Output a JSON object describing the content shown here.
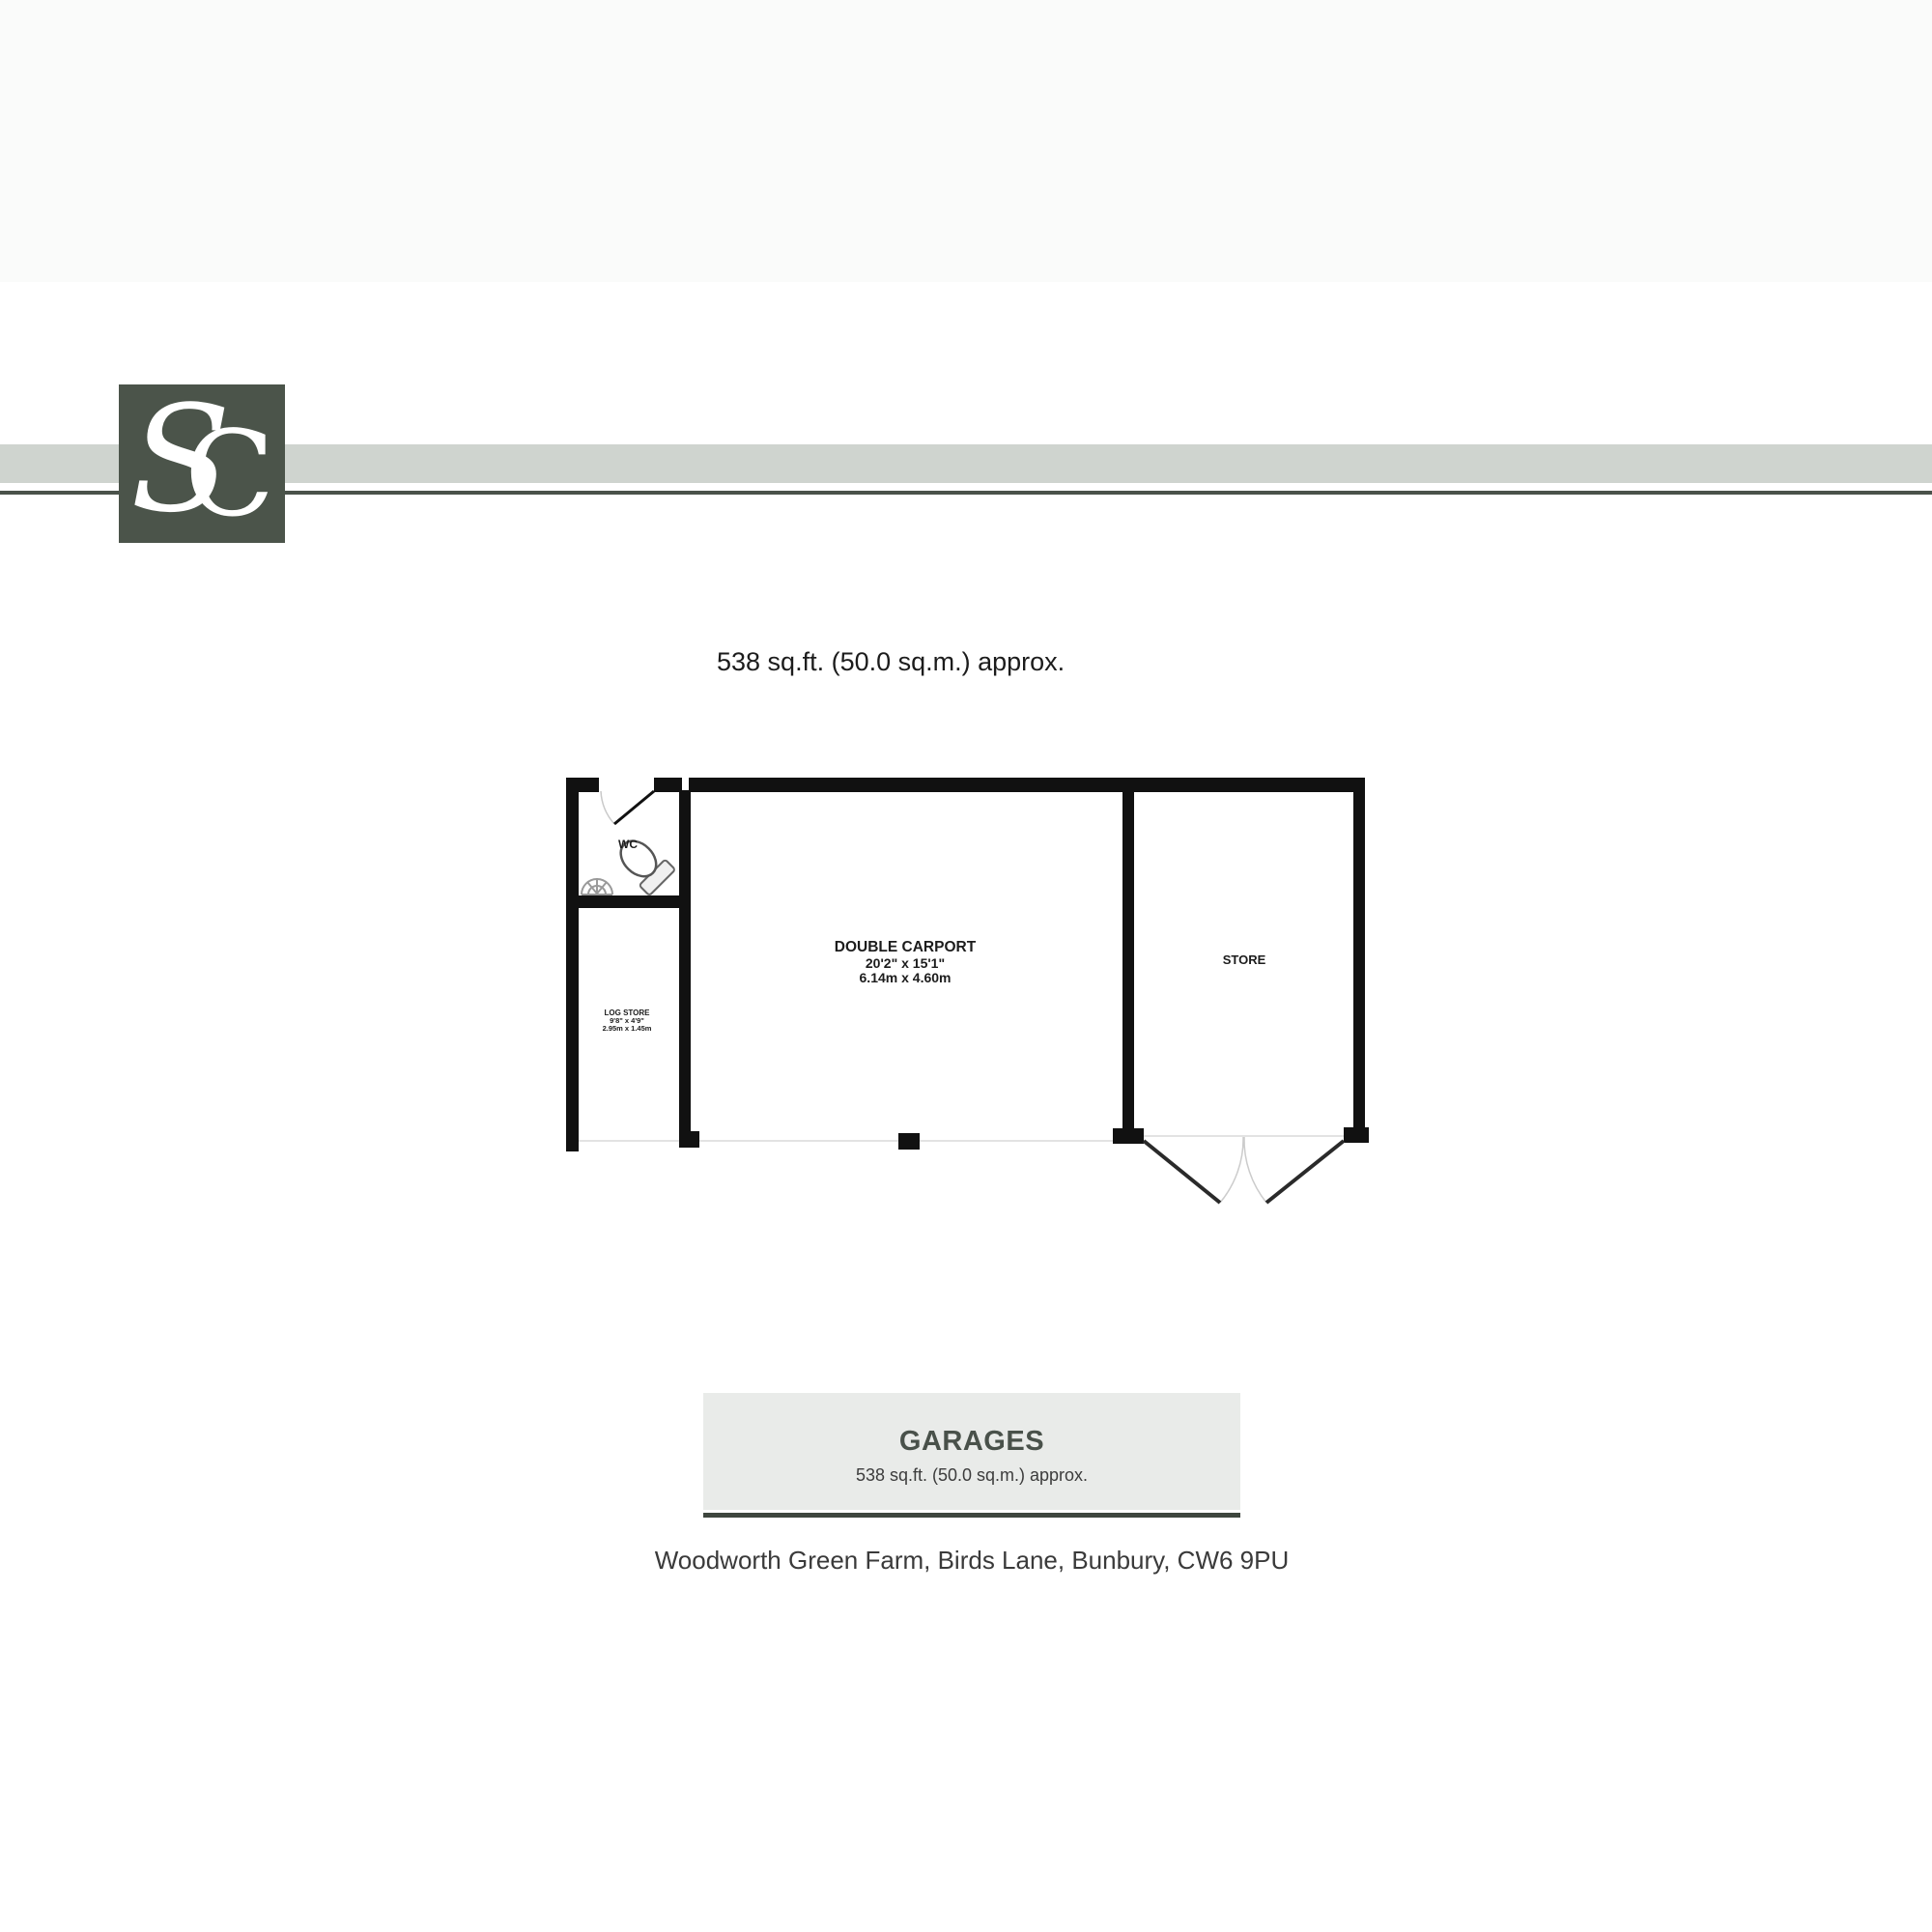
{
  "brand": {
    "monogram_s": "S",
    "monogram_c": "C",
    "logo_background": "#4b544a",
    "stripe_color": "#cfd4cf",
    "stripe_line_color": "#4a524a"
  },
  "plan": {
    "area_summary": "538 sq.ft. (50.0 sq.m.) approx.",
    "wall_color": "#111111",
    "rooms": {
      "wc": {
        "label": "WC"
      },
      "log_store": {
        "name": "LOG STORE",
        "size_imperial": "9'8\" x 4'9\"",
        "size_metric": "2.95m x 1.45m"
      },
      "double_carport": {
        "name": "DOUBLE CARPORT",
        "size_imperial": "20'2\" x 15'1\"",
        "size_metric": "6.14m x 4.60m"
      },
      "store": {
        "name": "STORE"
      }
    }
  },
  "footer": {
    "title": "GARAGES",
    "area": "538 sq.ft. (50.0 sq.m.) approx.",
    "address": "Woodworth Green Farm, Birds Lane, Bunbury, CW6 9PU",
    "box_background": "#e9ebe9",
    "underline_color": "#3e463e"
  }
}
